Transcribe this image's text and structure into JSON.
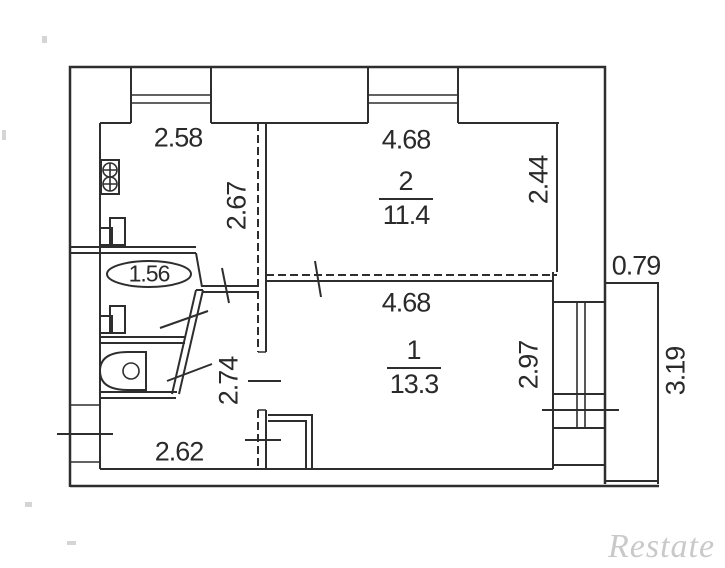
{
  "plan": {
    "rooms": {
      "room2": {
        "number": "2",
        "area": "11.4"
      },
      "room1": {
        "number": "1",
        "area": "13.3"
      }
    },
    "bathroom_area": "1.56",
    "dimensions": {
      "kitchen_width": "2.58",
      "kitchen_depth": "2.67",
      "room2_width": "4.68",
      "room2_depth": "2.44",
      "shaft_width": "0.79",
      "room1_width": "4.68",
      "room1_depth": "2.97",
      "hall_depth": "2.74",
      "hall_width": "2.62",
      "balcony_length": "3.19"
    },
    "watermark": "Restate",
    "colors": {
      "line": "#2e2e2e",
      "text": "#2a2a2a",
      "watermark": "#c9c9c9"
    }
  }
}
